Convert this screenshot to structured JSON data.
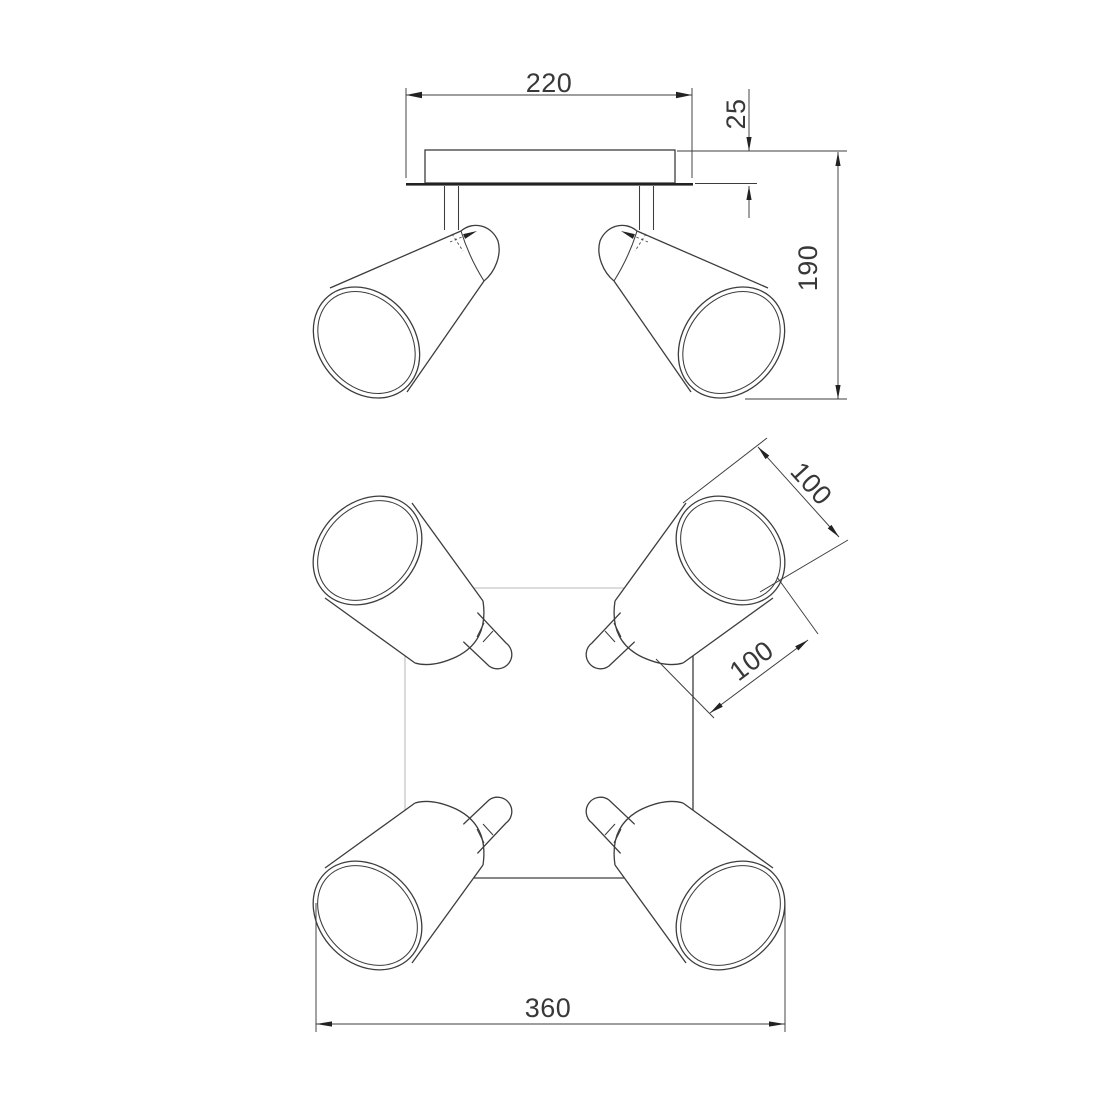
{
  "drawing": {
    "type": "technical-dimension-drawing",
    "subject": "four-spot ceiling light fixture, front elevation and plan view",
    "background": "#ffffff",
    "colors": {
      "ink": "#3d3d3d",
      "strong_edge": "#222222",
      "hidden_edge": "#b9b9b9"
    }
  },
  "dimensions": {
    "canopy_width": "220",
    "canopy_height": "25",
    "fixture_height": "190",
    "shade_diameter": "100",
    "shade_length": "100",
    "overall_width": "360"
  }
}
